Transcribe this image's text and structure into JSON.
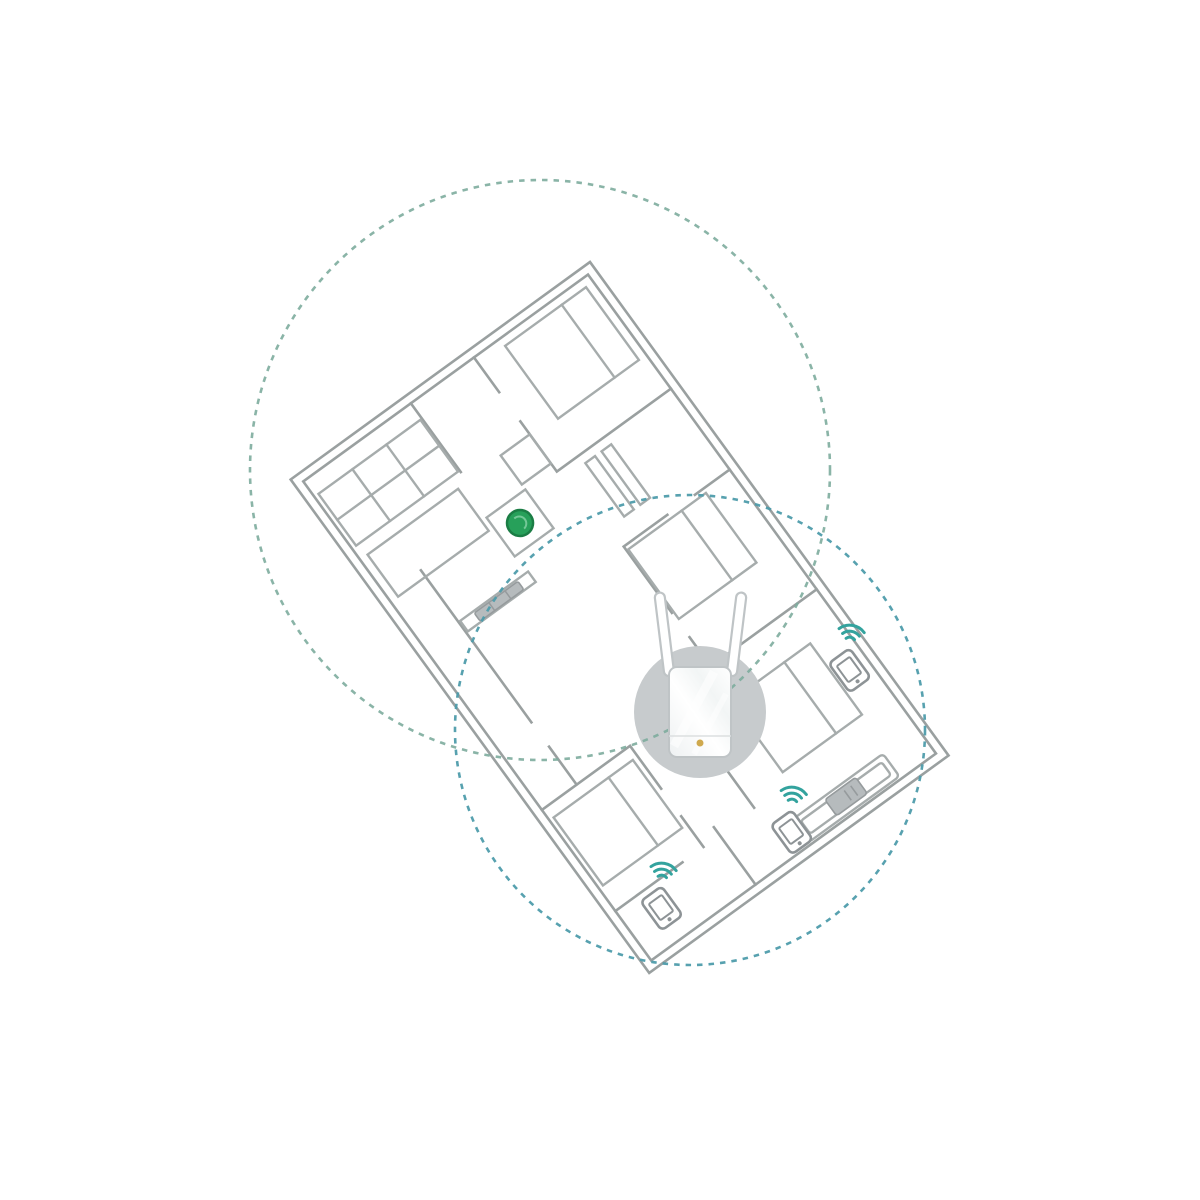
{
  "scene": {
    "type": "wifi-range-extender-coverage-diagram",
    "background": "#ffffff",
    "text_content": ""
  },
  "colors": {
    "wall-gray": "#9aa0a0",
    "furniture-gray": "#a6acac",
    "coverage-green": "#7dac9d",
    "coverage-blue": "#4e9cab",
    "router-green": "#27a05a",
    "router-green-dark": "#1b7d45",
    "router-green-light": "#82cfa2",
    "highlight-gray": "#c7cbcd",
    "device-border": "#bfc4c6",
    "wifi-teal": "#33a39e",
    "phone-gray": "#8d9396",
    "device-gray": "#b6bbbd",
    "logo-gold": "#cfa94e"
  },
  "coverage_circles": [
    {
      "id": "router-coverage",
      "source": "wireless-router",
      "style": "dashed",
      "color": "#7dac9d",
      "cx": 540,
      "cy": 470,
      "r": 290
    },
    {
      "id": "extender-coverage",
      "source": "range-extender",
      "style": "dashed",
      "color": "#4e9cab",
      "cx": 690,
      "cy": 730,
      "r": 235
    }
  ],
  "devices": {
    "router": {
      "name": "wireless-router",
      "icon": "router-dot",
      "color": "#27a05a"
    },
    "extender": {
      "name": "wifi-range-extender",
      "icon": "range-extender",
      "antenna_count": 2,
      "led_color": "#cfa94e",
      "highlight_circle_color": "#c7cbcd"
    },
    "clients": [
      {
        "name": "smartphone-bedroom-top-right",
        "icon": "smartphone",
        "wifi_connected": true
      },
      {
        "name": "smartphone-living-area",
        "icon": "smartphone",
        "wifi_connected": true
      },
      {
        "name": "smartphone-bottom-room",
        "icon": "smartphone",
        "wifi_connected": true
      }
    ],
    "media_console": {
      "name": "media-console",
      "icon": "console-on-sofa"
    },
    "tv": {
      "name": "television",
      "icon": "tv-on-cabinet"
    }
  },
  "floorplan": {
    "rotation_deg": 54,
    "rooms": [
      "bedroom-top-left",
      "bedroom-top-middle",
      "bedroom-top-right",
      "bedroom-bottom",
      "kitchen",
      "living-area",
      "hallway"
    ],
    "furniture": [
      "bed",
      "bed",
      "bed",
      "bed",
      "kitchen-counter-grid",
      "kitchen-island",
      "sofa",
      "tv-cabinet",
      "side-table",
      "router-table",
      "hall-shelves"
    ]
  }
}
